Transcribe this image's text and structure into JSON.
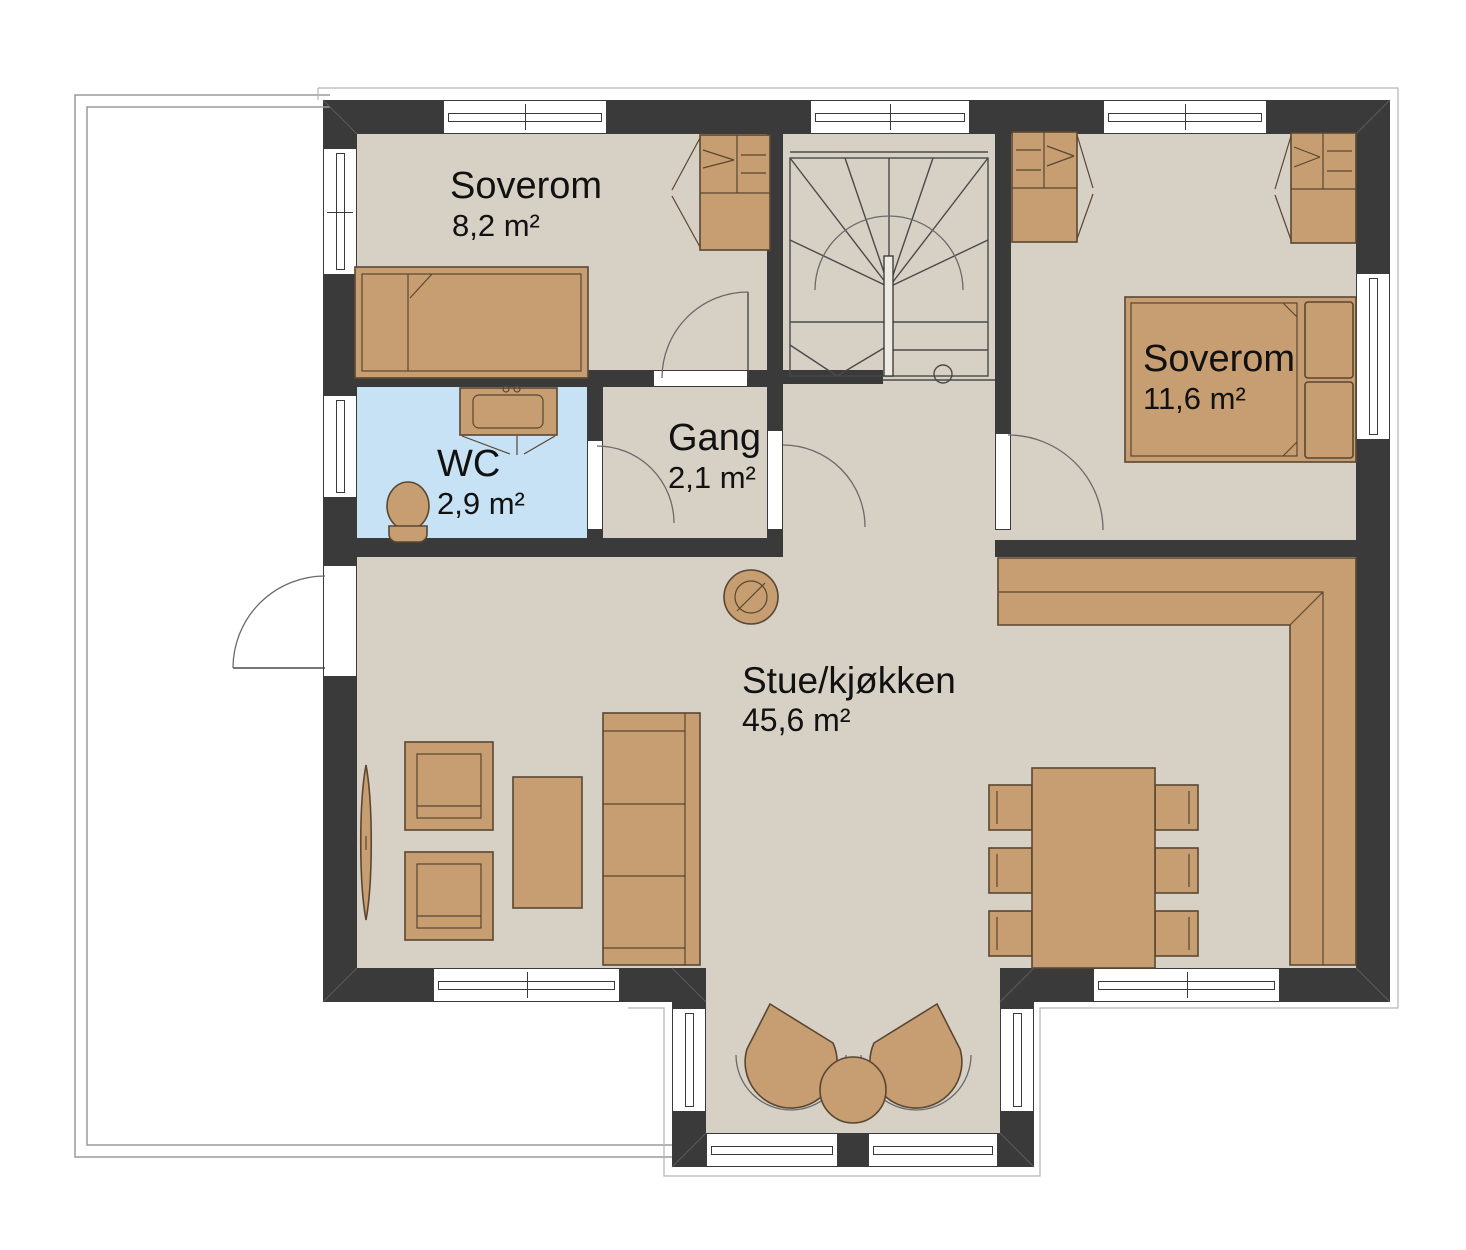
{
  "plan": {
    "type": "floor-plan",
    "rooms": [
      {
        "name": "Soverom",
        "area": "8,2 m²"
      },
      {
        "name": "WC",
        "area": "2,9 m²"
      },
      {
        "name": "Gang",
        "area": "2,1 m²"
      },
      {
        "name": "Soverom",
        "area": "11,6 m²"
      },
      {
        "name": "Stue/kjøkken",
        "area": "45,6 m²"
      }
    ]
  },
  "colors": {
    "background": "#ffffff",
    "wall": "#3a3a3a",
    "floor": "#d7d0c5",
    "wc_floor": "#c7e2f4",
    "furniture": "#c69e71",
    "furniture_stroke": "#5a4631",
    "detail_line": "#4a4a4a",
    "arc_line": "#6a6a6a",
    "terrace_line": "#9a9a9a",
    "overhang_line": "#b5b5b5",
    "window_frame": "#3a3a3a",
    "text": "#111111"
  }
}
